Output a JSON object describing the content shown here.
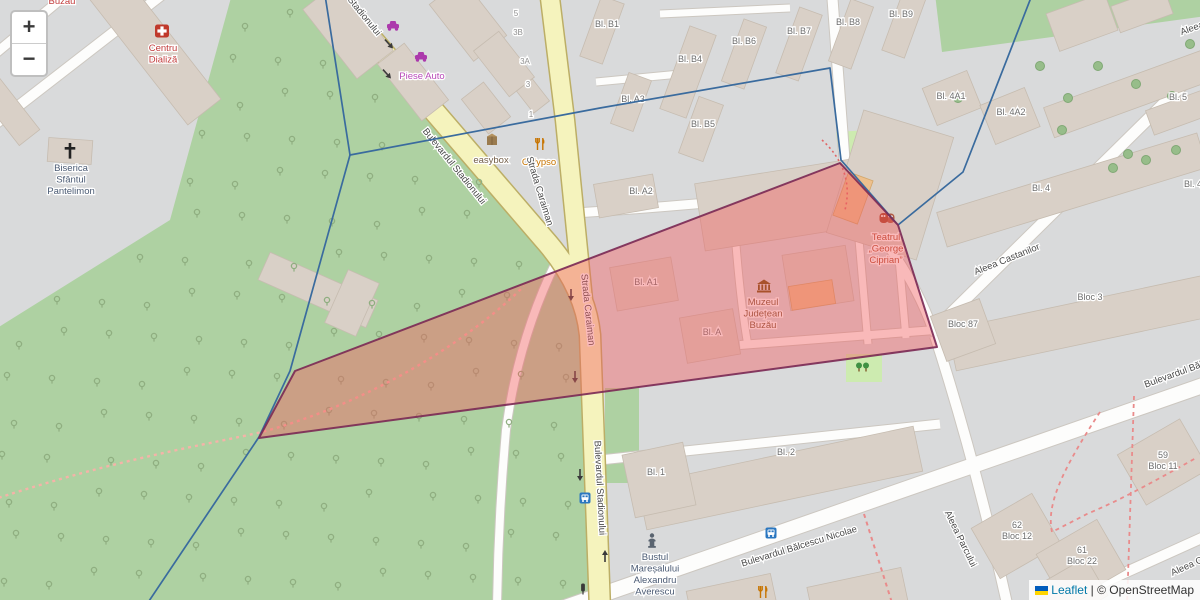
{
  "controls": {
    "zoom_in": "+",
    "zoom_out": "−"
  },
  "attribution": {
    "leaflet": "Leaflet",
    "separator": " | ",
    "osm": "© OpenStreetMap"
  },
  "colors": {
    "background": "#d9dadb",
    "park": "#aed1a2",
    "grass": "#cdebb0",
    "road_yellow": "#f5f3bd",
    "road_casing": "#bcae66",
    "building": "#d9d0c7",
    "building_orange": "#edc08d",
    "polygon_fill": "#f25b5e",
    "polygon_stroke": "#7c2b56",
    "boundary_blue": "#3a6b9e",
    "street_text": "#4a4a4a",
    "block_text": "#6d6d6d"
  },
  "map": {
    "streets": [
      {
        "text": "Stadionului",
        "x": 362,
        "y": 18,
        "rot": 51
      },
      {
        "text": "Bulevardul Stadionului",
        "x": 452,
        "y": 168,
        "rot": 51
      },
      {
        "text": "Strada Caraiman",
        "x": 537,
        "y": 192,
        "rot": 73
      },
      {
        "text": "Strada Caraiman",
        "x": 585,
        "y": 310,
        "rot": 84
      },
      {
        "text": "Bulevardul Stadionului",
        "x": 597,
        "y": 488,
        "rot": 87
      },
      {
        "text": "Aleea Castanilor",
        "x": 1008,
        "y": 262,
        "rot": -22
      },
      {
        "text": "Bulevardul Bălcescu Nicolae",
        "x": 800,
        "y": 549,
        "rot": -17
      },
      {
        "text": "Bulevardul Bălcescu",
        "x": 1186,
        "y": 373,
        "rot": -20
      },
      {
        "text": "Aleea Parcului",
        "x": 958,
        "y": 540,
        "rot": 64
      },
      {
        "text": "Aleea",
        "x": 1193,
        "y": 31,
        "rot": -20
      },
      {
        "text": "Aleea C",
        "x": 1188,
        "y": 569,
        "rot": -24
      }
    ],
    "blocks": [
      {
        "text": "Bl. B1",
        "x": 607,
        "y": 27
      },
      {
        "text": "Bl. B4",
        "x": 690,
        "y": 62
      },
      {
        "text": "Bl. B6",
        "x": 744,
        "y": 44
      },
      {
        "text": "Bl. B7",
        "x": 799,
        "y": 34
      },
      {
        "text": "Bl. B8",
        "x": 848,
        "y": 25
      },
      {
        "text": "Bl. B9",
        "x": 901,
        "y": 17
      },
      {
        "text": "Bl. A3",
        "x": 633,
        "y": 102
      },
      {
        "text": "Bl. B5",
        "x": 703,
        "y": 127
      },
      {
        "text": "Bl. A2",
        "x": 641,
        "y": 194
      },
      {
        "text": "Bl. A1",
        "x": 646,
        "y": 285
      },
      {
        "text": "Bl. A",
        "x": 712,
        "y": 335
      },
      {
        "text": "Bl. 4A1",
        "x": 951,
        "y": 99
      },
      {
        "text": "Bl. 4A2",
        "x": 1011,
        "y": 115
      },
      {
        "text": "Bl. 5",
        "x": 1178,
        "y": 100
      },
      {
        "text": "Bl. 4",
        "x": 1041,
        "y": 191
      },
      {
        "text": "Bl. 4",
        "x": 1193,
        "y": 187
      },
      {
        "text": "Bloc 3",
        "x": 1090,
        "y": 300
      },
      {
        "text": "Bloc 87",
        "x": 963,
        "y": 327
      },
      {
        "text": "Bl. 1",
        "x": 656,
        "y": 475
      },
      {
        "text": "Bl. 2",
        "x": 786,
        "y": 455
      },
      {
        "lines": [
          "59",
          "Bloc 11"
        ],
        "x": 1163,
        "y": 458
      },
      {
        "lines": [
          "62",
          "Bloc 12"
        ],
        "x": 1017,
        "y": 528
      },
      {
        "lines": [
          "61",
          "Bloc 22"
        ],
        "x": 1082,
        "y": 553
      }
    ],
    "houses": [
      {
        "text": "5",
        "x": 516,
        "y": 16
      },
      {
        "text": "3B",
        "x": 518,
        "y": 35
      },
      {
        "text": "3A",
        "x": 525,
        "y": 64
      },
      {
        "text": "3",
        "x": 528,
        "y": 87
      },
      {
        "text": "1",
        "x": 531,
        "y": 117
      }
    ],
    "pois": [
      {
        "icon": "medical-cross",
        "x": 162,
        "y": 31,
        "color": "#c0392b",
        "lines": [
          "Centru",
          "Dializă"
        ],
        "lx": 163,
        "ly": 51,
        "lcolor": "#c23b3b"
      },
      {
        "icon": "christian-cross",
        "x": 70,
        "y": 152,
        "color": "#222222",
        "lines": [
          "Biserica",
          "Sfântul",
          "Pantelimon"
        ],
        "lx": 71,
        "ly": 171,
        "lcolor": "#4a5a73"
      },
      {
        "icon": "car-shop",
        "x": 393,
        "y": 26,
        "color": "#ac39ac"
      },
      {
        "icon": "car-shop",
        "x": 421,
        "y": 57,
        "color": "#ac39ac",
        "lines": [
          "Piese Auto"
        ],
        "lx": 422,
        "ly": 79,
        "lcolor": "#b84ab8"
      },
      {
        "icon": "parcel-locker",
        "x": 492,
        "y": 140,
        "color": "#8a6d3b",
        "lines": [
          "easybox"
        ],
        "lx": 491,
        "ly": 163,
        "lcolor": "#75604a"
      },
      {
        "icon": "restaurant",
        "x": 540,
        "y": 144,
        "color": "#c77400",
        "lines": [
          "Calypso"
        ],
        "lx": 539,
        "ly": 165,
        "lcolor": "#c77400"
      },
      {
        "icon": "museum",
        "x": 764,
        "y": 287,
        "color": "#734a08",
        "lines": [
          "Muzeul",
          "Județean",
          "Buzău"
        ],
        "lx": 763,
        "ly": 305,
        "lcolor": "#7a5230"
      },
      {
        "icon": "theatre",
        "x": 887,
        "y": 218,
        "color": "#a8442a",
        "lines": [
          "Teatrul",
          "„George",
          "Ciprian”"
        ],
        "lx": 886,
        "ly": 240,
        "lcolor": "#b0482a"
      },
      {
        "icon": "monument",
        "x": 652,
        "y": 540,
        "color": "#5a6470",
        "lines": [
          "Bustul",
          "Mareșalului",
          "Alexandru",
          "Averescu"
        ],
        "lx": 655,
        "ly": 560,
        "lcolor": "#4a5a73"
      },
      {
        "icon": "bus-stop",
        "x": 585,
        "y": 498,
        "color": "#2b77c0"
      },
      {
        "icon": "bus-stop",
        "x": 771,
        "y": 533,
        "color": "#2b77c0"
      },
      {
        "icon": "traffic-light",
        "x": 583,
        "y": 589,
        "color": "#3a3a3a"
      },
      {
        "icon": "restaurant",
        "x": 763,
        "y": 592,
        "color": "#c77400"
      },
      {
        "icon": "park-trees",
        "x": 863,
        "y": 368,
        "color": "#3f9143"
      },
      {
        "icon": null,
        "x": 62,
        "y": 2,
        "lines": [
          "Buzău"
        ],
        "lx": 62,
        "ly": 4,
        "lcolor": "#c23b3b"
      }
    ],
    "overlays": {
      "polygon": {
        "points": [
          [
            259,
            438
          ],
          [
            295,
            371
          ],
          [
            840,
            163
          ],
          [
            898,
            225
          ],
          [
            937,
            347
          ]
        ],
        "fill": "#f25b5e",
        "fill_opacity": 0.42,
        "stroke": "#7c2b56",
        "stroke_width": 2
      },
      "boundaries": [
        {
          "points": [
            [
              325,
              -5
            ],
            [
              350,
              155
            ],
            [
              600,
              108
            ],
            [
              830,
              68
            ],
            [
              841,
              160
            ],
            [
              898,
              225
            ],
            [
              963,
              172
            ],
            [
              1032,
              -5
            ]
          ]
        },
        {
          "points": [
            [
              350,
              155
            ],
            [
              290,
              371
            ],
            [
              259,
              437
            ],
            [
              147,
              604
            ]
          ]
        }
      ],
      "boundary_color": "#3a6b9e",
      "boundary_width": 1.7
    }
  }
}
